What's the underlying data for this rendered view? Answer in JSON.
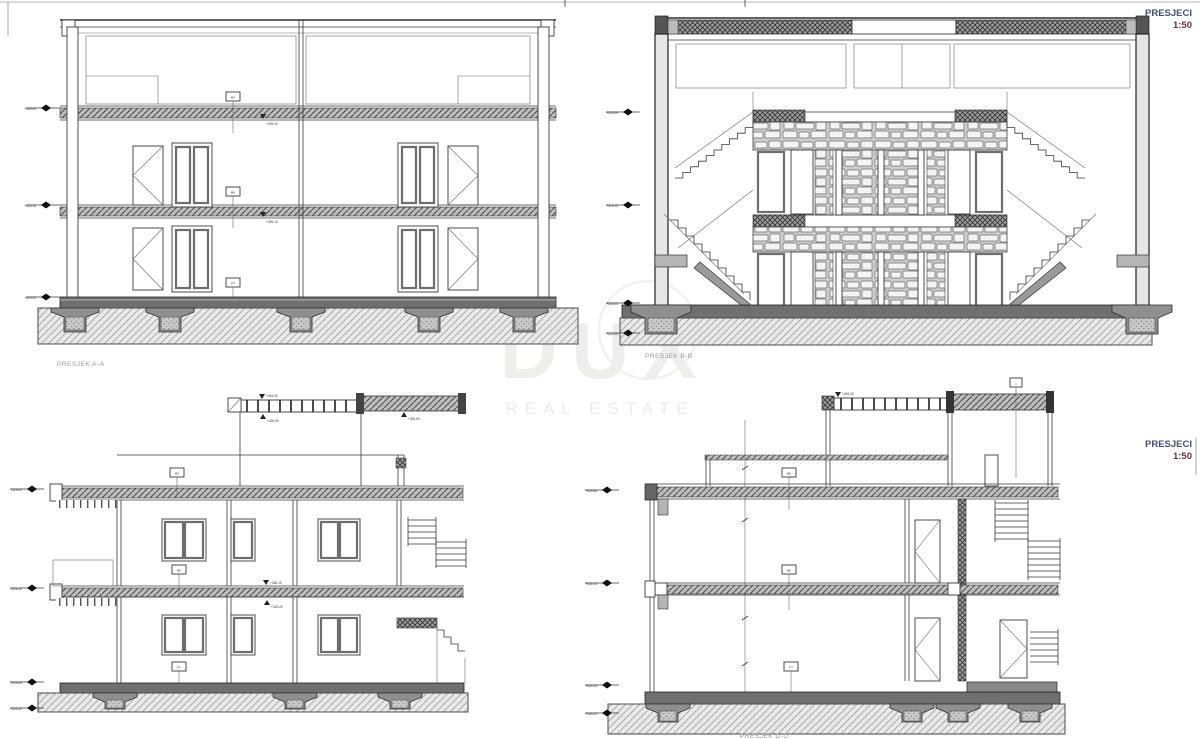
{
  "titles": {
    "top_right": {
      "title": "PRESJECI",
      "scale": "1:50"
    },
    "mid_right": {
      "title": "PRESJECI",
      "scale": "1:50"
    }
  },
  "sections": {
    "a": {
      "label": "PRESJEK A-A"
    },
    "b": {
      "label": "PRESJEK B-B"
    },
    "d": {
      "label": "PRESJEK D-D"
    }
  },
  "watermark": {
    "line1": "DUX",
    "line2": "REAL ESTATE"
  },
  "annotations": {
    "tag_mk": "MK",
    "tag_pt": "PT",
    "tag_1": "1",
    "elev_roof": "+429.00",
    "elev_mid": "+426.10",
    "elev_ground": "+423.20",
    "elev_parapet": "+434.30",
    "elev_top": "+432.60",
    "elev_deck": "+429.60"
  },
  "colors": {
    "line": "#3a3a3a",
    "slab_dark": "#6f6f6f",
    "watermark": "#f0eeeb",
    "title_blue": "#44506e",
    "scale_red": "#76302a",
    "label_gray": "#9a9a9a"
  }
}
